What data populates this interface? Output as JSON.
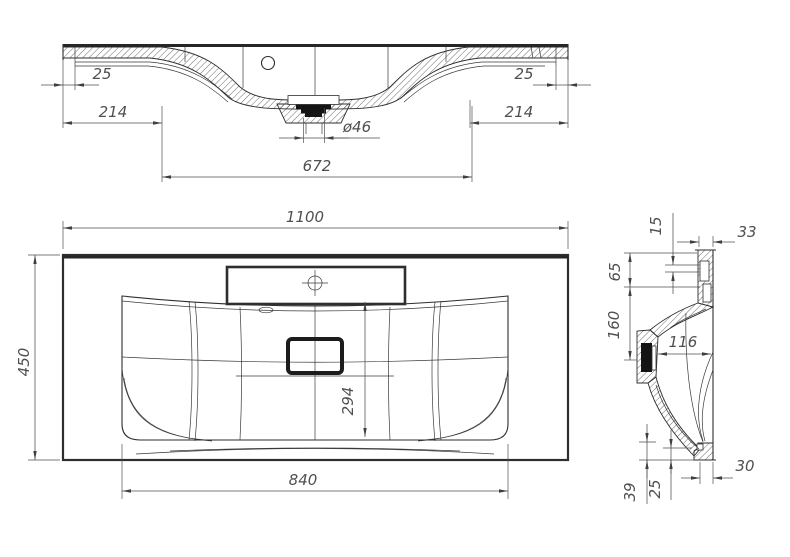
{
  "colors": {
    "background": "#ffffff",
    "line": "#2e2e2e",
    "dimension": "#4f4f4f"
  },
  "front_section": {
    "dims": {
      "left_rim": "25",
      "left_deck": "214",
      "drain_diameter": "ø46",
      "bowl_width": "672",
      "right_rim": "25",
      "right_deck": "214"
    }
  },
  "plan_view": {
    "dims": {
      "overall_width": "1100",
      "overall_depth": "450",
      "bowl_depth": "294",
      "bowl_width": "840"
    }
  },
  "side_section": {
    "dims": {
      "deck_lip": "15",
      "rim_thickness": "33",
      "upper_step": "65",
      "mid_depth": "160",
      "bowl_inner": "116",
      "bottom_ledge": "30",
      "front_step": "39",
      "front_inner": "25"
    }
  }
}
